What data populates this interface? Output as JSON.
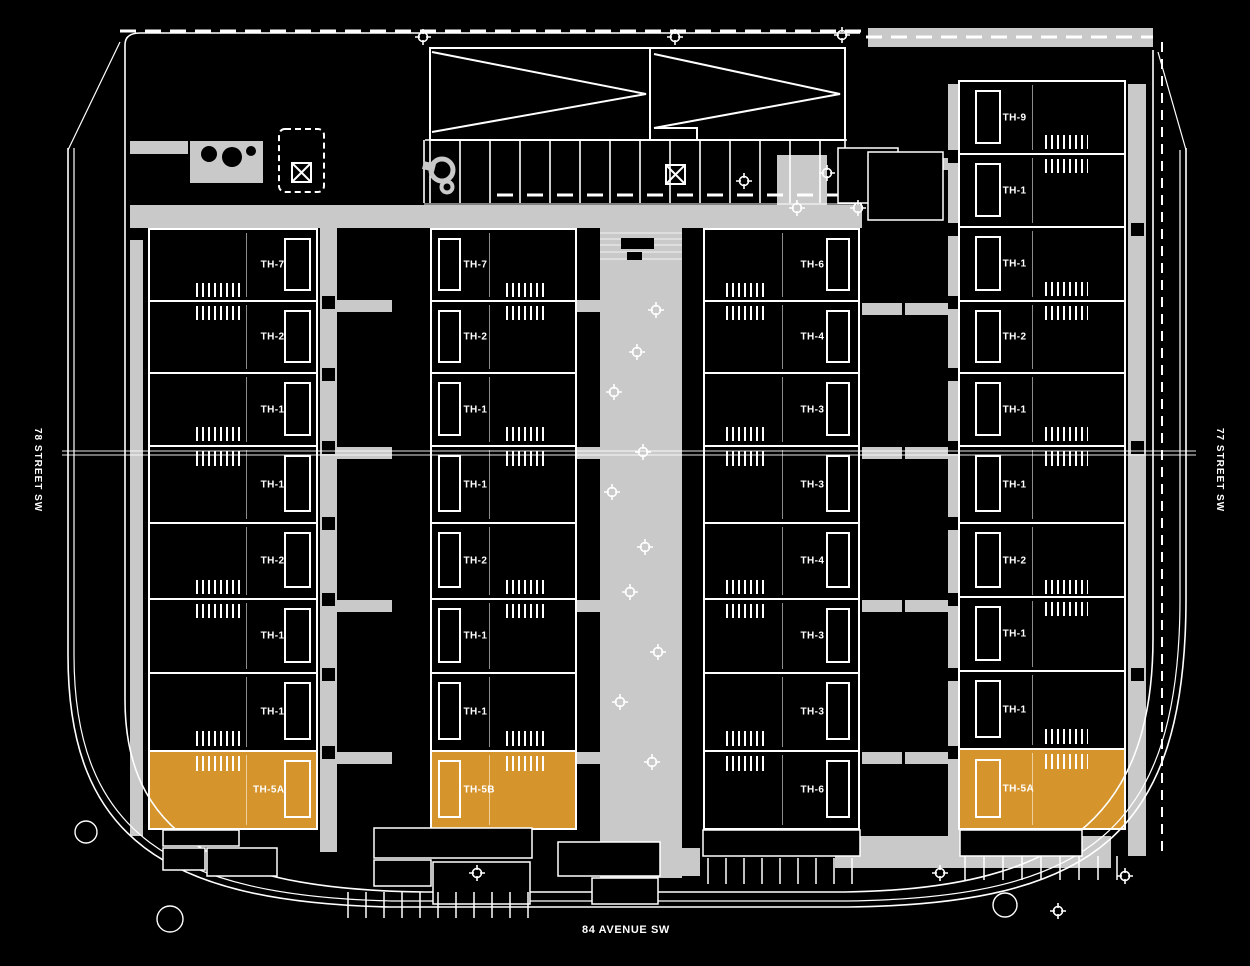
{
  "plan": {
    "title": "townhouse-site-plan",
    "streets": {
      "left": "78 STREET SW",
      "right": "77 STREET SW",
      "bottom": "84 AVENUE SW"
    },
    "colors": {
      "background": "#000000",
      "linework": "#ffffff",
      "walkway": "#c9c9c9",
      "highlight": "#d5942c"
    },
    "buildings": [
      {
        "name": "building-a",
        "units": [
          {
            "label": "TH-7"
          },
          {
            "label": "TH-2"
          },
          {
            "label": "TH-1"
          },
          {
            "label": "TH-1"
          },
          {
            "label": "TH-2"
          },
          {
            "label": "TH-1"
          },
          {
            "label": "TH-1"
          },
          {
            "label": "TH-5A",
            "highlighted": true
          }
        ]
      },
      {
        "name": "building-b",
        "units": [
          {
            "label": "TH-7"
          },
          {
            "label": "TH-2"
          },
          {
            "label": "TH-1"
          },
          {
            "label": "TH-1"
          },
          {
            "label": "TH-2"
          },
          {
            "label": "TH-1"
          },
          {
            "label": "TH-1"
          },
          {
            "label": "TH-5B",
            "highlighted": true
          }
        ]
      },
      {
        "name": "building-c",
        "units": [
          {
            "label": "TH-6"
          },
          {
            "label": "TH-4"
          },
          {
            "label": "TH-3"
          },
          {
            "label": "TH-3"
          },
          {
            "label": "TH-4"
          },
          {
            "label": "TH-3"
          },
          {
            "label": "TH-3"
          },
          {
            "label": "TH-6"
          }
        ]
      },
      {
        "name": "building-d",
        "units": [
          {
            "label": "TH-9"
          },
          {
            "label": "TH-1"
          },
          {
            "label": "TH-1"
          },
          {
            "label": "TH-2"
          },
          {
            "label": "TH-1"
          },
          {
            "label": "TH-1"
          },
          {
            "label": "TH-2"
          },
          {
            "label": "TH-1"
          },
          {
            "label": "TH-1"
          },
          {
            "label": "TH-5A",
            "highlighted": true
          }
        ]
      }
    ],
    "highlighted_units": [
      "TH-5A",
      "TH-5B",
      "TH-5A"
    ],
    "symbols": {
      "transformer_pad": "x-box-icon",
      "garbage_enclosure": "three-circles-pad",
      "hose_bib": "hook-icon",
      "site_light": "crosshair-icon",
      "parking": "stall-lines"
    }
  }
}
